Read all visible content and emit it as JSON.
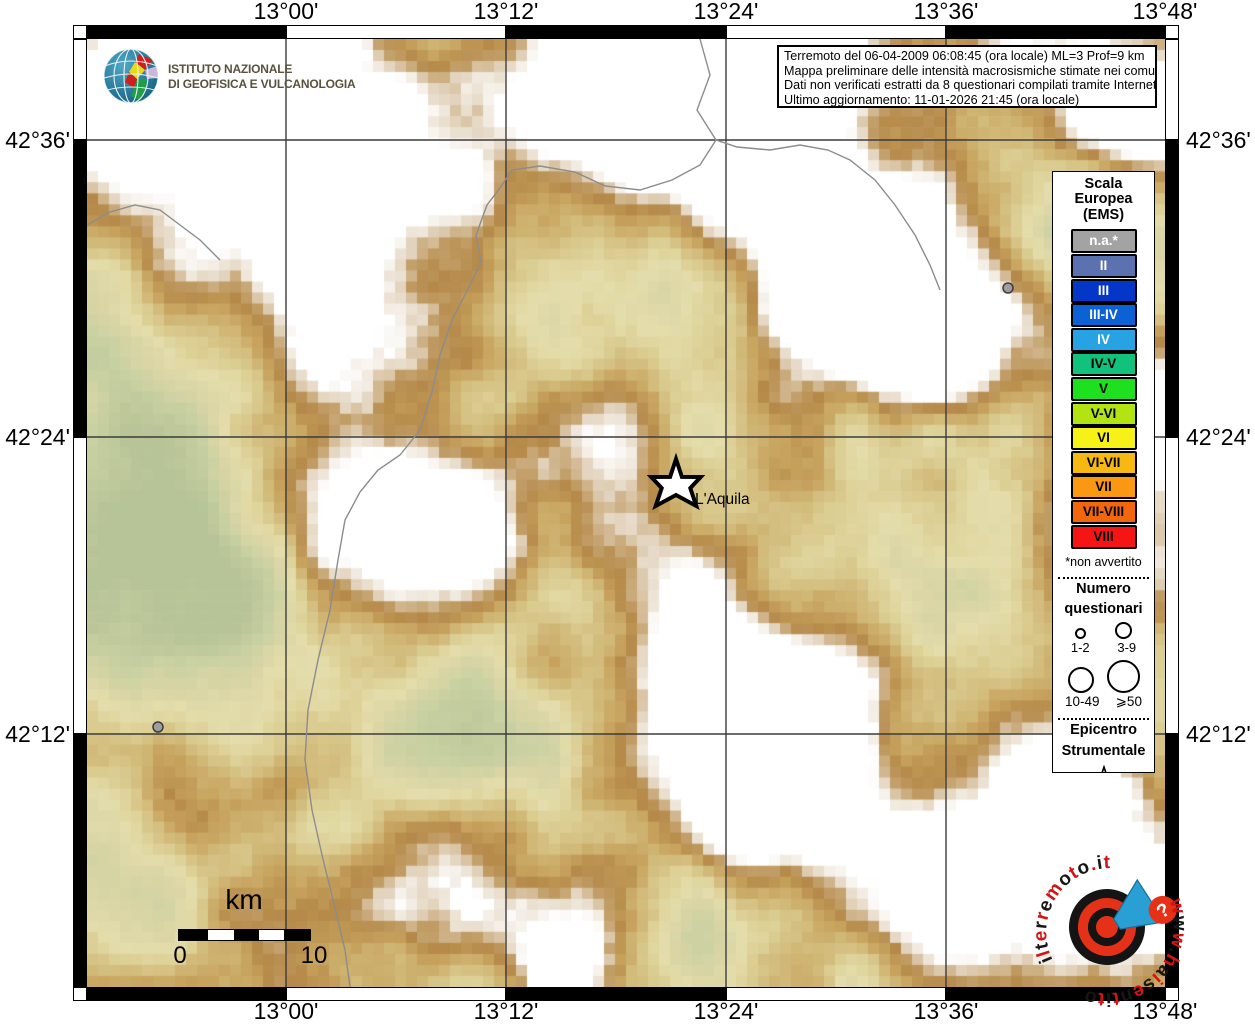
{
  "header": {
    "logo": {
      "org_line1": "ISTITUTO NAZIONALE",
      "org_line2": "DI GEOFISICA E VULCANOLOGIA"
    },
    "info_box": {
      "lines": [
        "Terremoto del 06-04-2009 06:08:45 (ora locale) ML=3 Prof=9 km",
        "Mappa preliminare delle intensità macrosismiche stimate nei comuni",
        "Dati non verificati estratti da 8 questionari compilati tramite Internet.",
        "Ultimo aggiornamento: 11-01-2026 21:45 (ora locale)"
      ]
    }
  },
  "axes": {
    "top": [
      "13°00'",
      "13°12'",
      "13°24'",
      "13°36'",
      "13°48'"
    ],
    "bottom": [
      "13°00'",
      "13°12'",
      "13°24'",
      "13°36'",
      "13°48'"
    ],
    "left": [
      "42°36'",
      "42°24'",
      "42°12'"
    ],
    "right": [
      "42°36'",
      "42°24'",
      "42°12'"
    ]
  },
  "map": {
    "epicenter": {
      "label": "L'Aquila"
    },
    "scale_bar": {
      "unit": "km",
      "start_label": "0",
      "end_label": "10"
    }
  },
  "legend": {
    "title_lines": [
      "Scala",
      "Europea",
      "(EMS)"
    ],
    "classes": [
      {
        "label": "n.a.*",
        "color": "#a3a3a3",
        "text": "#ffffff"
      },
      {
        "label": "II",
        "color": "#5c71b0",
        "text": "#ffffff"
      },
      {
        "label": "III",
        "color": "#0437c8",
        "text": "#ffffff"
      },
      {
        "label": "III-IV",
        "color": "#0c62d4",
        "text": "#ffffff"
      },
      {
        "label": "IV",
        "color": "#27a3e4",
        "text": "#ffffff"
      },
      {
        "label": "IV-V",
        "color": "#12c17c",
        "text": "#000000"
      },
      {
        "label": "V",
        "color": "#1ee01e",
        "text": "#000000"
      },
      {
        "label": "V-VI",
        "color": "#b2e414",
        "text": "#000000"
      },
      {
        "label": "VI",
        "color": "#f6f218",
        "text": "#000000"
      },
      {
        "label": "VI-VII",
        "color": "#f6b913",
        "text": "#000000"
      },
      {
        "label": "VII",
        "color": "#fa9713",
        "text": "#000000"
      },
      {
        "label": "VII-VIII",
        "color": "#f2660e",
        "text": "#000000"
      },
      {
        "label": "VIII",
        "color": "#f51515",
        "text": "#000000"
      }
    ],
    "footnote": "*non avvertito",
    "questionnaires": {
      "title_lines": [
        "Numero",
        "questionari"
      ],
      "bins": [
        {
          "label": "1-2"
        },
        {
          "label": "3-9"
        },
        {
          "label": "10-49"
        },
        {
          "label": "⩾50"
        }
      ]
    },
    "epicenter_section": {
      "title_lines": [
        "Epicentro",
        "Strumentale"
      ]
    }
  },
  "watermark": {
    "arc_top": "ilterremoto.it",
    "arc_bottom": "www.haisentito",
    "badge": "?"
  }
}
